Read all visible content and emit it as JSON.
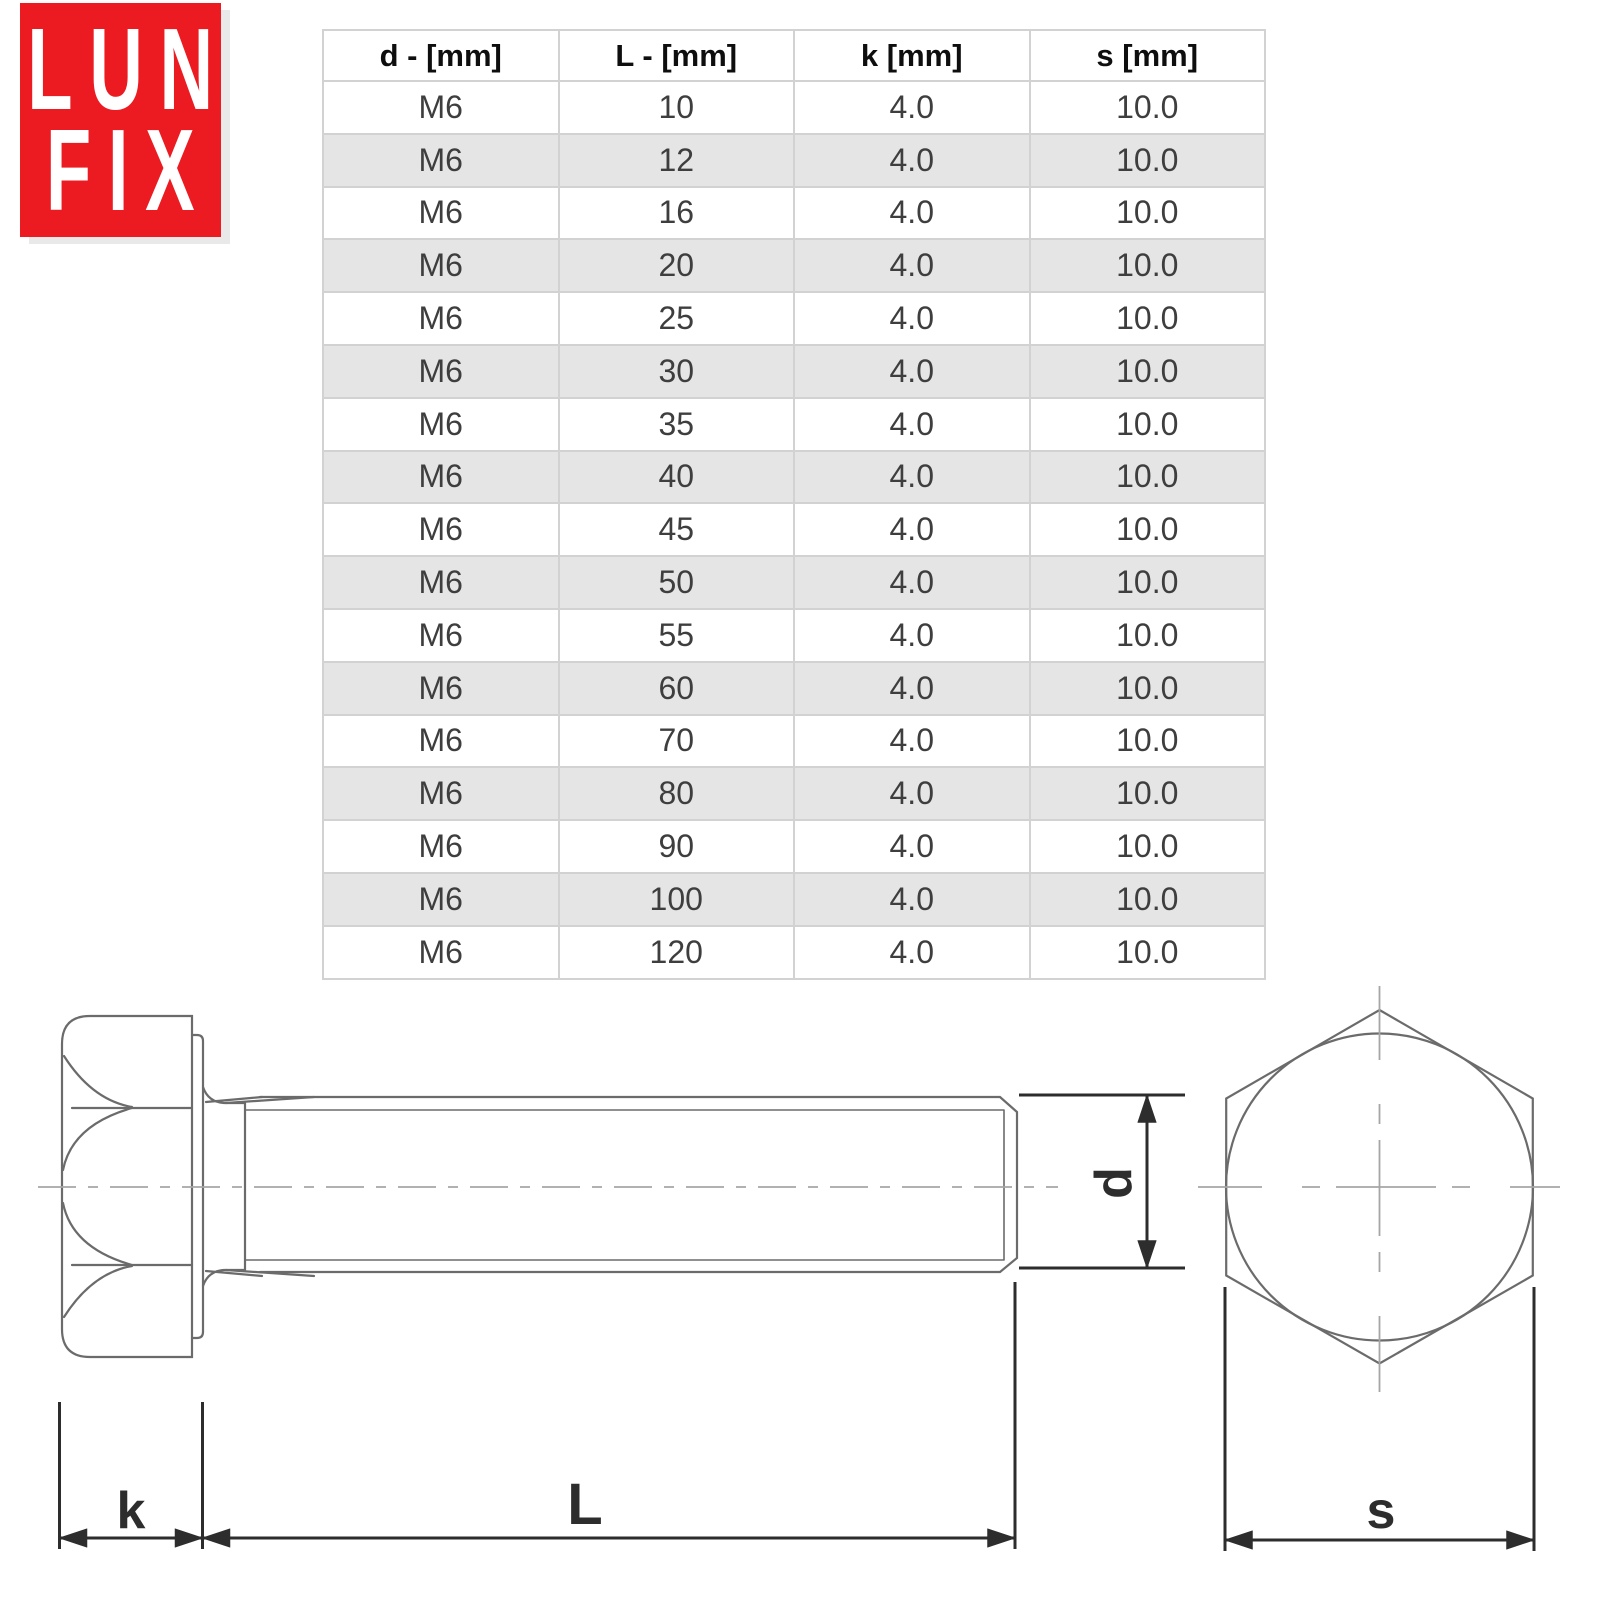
{
  "logo": {
    "line1": "LUN",
    "line2": "FIX",
    "bg_color": "#EC1B21",
    "text_color": "#FFFFFF"
  },
  "table": {
    "columns": [
      "d - [mm]",
      "L - [mm]",
      "k [mm]",
      "s [mm]"
    ],
    "rows": [
      [
        "M6",
        "10",
        "4.0",
        "10.0"
      ],
      [
        "M6",
        "12",
        "4.0",
        "10.0"
      ],
      [
        "M6",
        "16",
        "4.0",
        "10.0"
      ],
      [
        "M6",
        "20",
        "4.0",
        "10.0"
      ],
      [
        "M6",
        "25",
        "4.0",
        "10.0"
      ],
      [
        "M6",
        "30",
        "4.0",
        "10.0"
      ],
      [
        "M6",
        "35",
        "4.0",
        "10.0"
      ],
      [
        "M6",
        "40",
        "4.0",
        "10.0"
      ],
      [
        "M6",
        "45",
        "4.0",
        "10.0"
      ],
      [
        "M6",
        "50",
        "4.0",
        "10.0"
      ],
      [
        "M6",
        "55",
        "4.0",
        "10.0"
      ],
      [
        "M6",
        "60",
        "4.0",
        "10.0"
      ],
      [
        "M6",
        "70",
        "4.0",
        "10.0"
      ],
      [
        "M6",
        "80",
        "4.0",
        "10.0"
      ],
      [
        "M6",
        "90",
        "4.0",
        "10.0"
      ],
      [
        "M6",
        "100",
        "4.0",
        "10.0"
      ],
      [
        "M6",
        "120",
        "4.0",
        "10.0"
      ]
    ],
    "alt_row_color": "#e5e5e5",
    "border_color": "#d2d2d2",
    "header_text_color": "#0e0e0e",
    "cell_text_color": "#3e3e3e"
  },
  "drawing": {
    "k_label": "k",
    "l_label": "L",
    "d_label": "d",
    "s_label": "s",
    "outline_color": "#6b6b6b",
    "centerline_color": "#a6a6a6",
    "dimension_color": "#2d2d2d"
  }
}
